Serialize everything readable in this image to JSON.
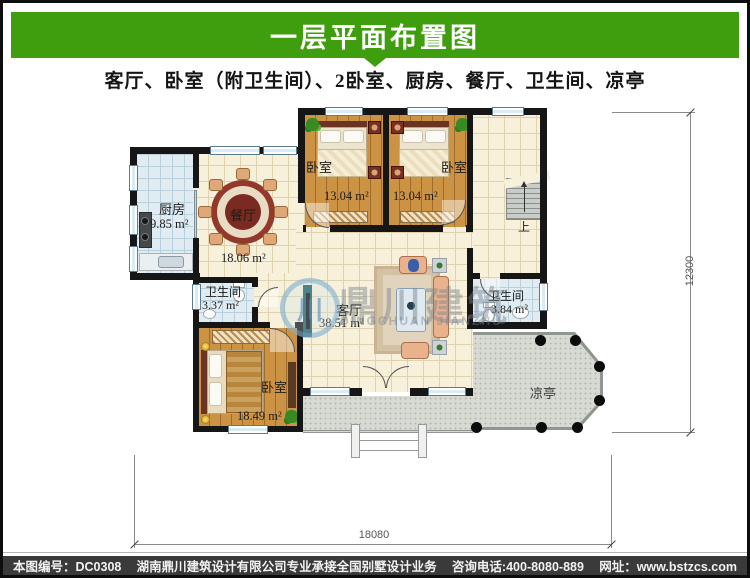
{
  "header": {
    "title": "一层平面布置图",
    "subtitle": "客厅、卧室（附卫生间）、2卧室、厨房、餐厅、卫生间、凉亭"
  },
  "rooms": {
    "kitchen": {
      "name": "厨房",
      "area": "9.85 m²"
    },
    "dining": {
      "name": "餐厅",
      "area": "18.06 m²"
    },
    "bedroom1": {
      "name": "卧室",
      "area": "13.04 m²"
    },
    "bedroom2": {
      "name": "卧室",
      "area": "13.04 m²"
    },
    "bedroom3": {
      "name": "卧室",
      "area": "18.49 m²"
    },
    "bath1": {
      "name": "卫生间",
      "area": "3.37 m²"
    },
    "bath2": {
      "name": "卫生间",
      "area": "3.84 m²"
    },
    "living": {
      "name": "客厅",
      "area": "38.51 m²"
    },
    "pavilion": {
      "name": "凉亭"
    },
    "stairs": {
      "up_label": "上"
    }
  },
  "dimensions": {
    "width_mm": "18080",
    "height_mm": "12300"
  },
  "watermark": {
    "logo_glyph": "川",
    "name_cn": "鼎川建筑",
    "name_en": "DINGCHUAN JIANZHU"
  },
  "footer": {
    "code": "本图编号：DC0308",
    "company": "湖南鼎川建筑设计有限公司专业承接全国别墅设计业务",
    "phone": "咨询电话:400-8080-889",
    "website": "网址：www.bstzcs.com"
  },
  "colors": {
    "accent_green": "#3f9e0d",
    "footer_bar": "#3b3a3a",
    "wall": "#161616",
    "terrace": "#d6dad2"
  }
}
